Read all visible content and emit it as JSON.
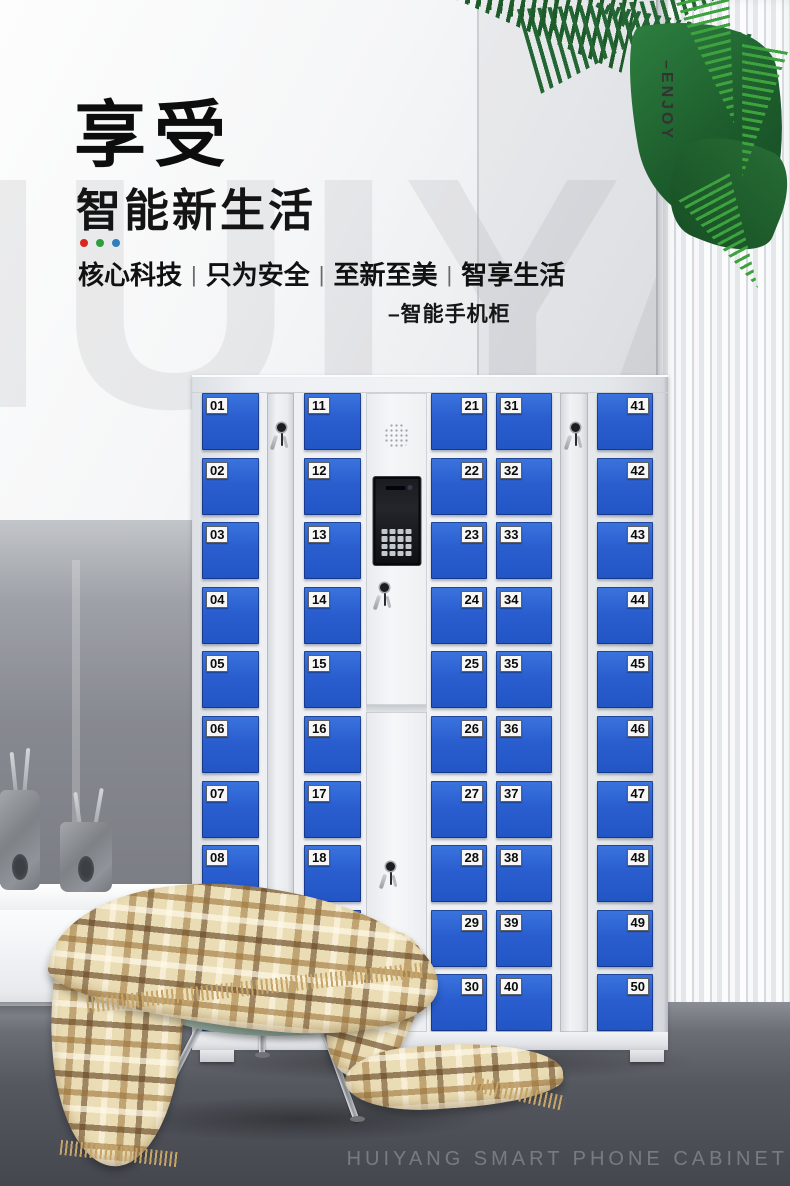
{
  "header": {
    "title": "享受",
    "subtitle": "智能新生活",
    "dot_colors": [
      "#d8271c",
      "#2e9e3e",
      "#2f7fc0"
    ],
    "tagline": [
      "核心科技",
      "只为安全",
      "至新至美",
      "智享生活"
    ],
    "separator": "|",
    "product_label": "–智能手机柜",
    "enjoy_label": "–ENJOY"
  },
  "watermark": {
    "background_text": "HUIYANG",
    "floor_text": "HUIYANG SMART PHONE CABINET"
  },
  "cabinet": {
    "door_color": "#2a5ecf",
    "body_color": "#eef0f3",
    "columns": [
      {
        "type": "doors",
        "label_side": "left",
        "numbers": [
          "01",
          "02",
          "03",
          "04",
          "05",
          "06",
          "07",
          "08",
          "09",
          "10"
        ]
      },
      {
        "type": "lock-strip"
      },
      {
        "type": "doors",
        "label_side": "left",
        "numbers": [
          "11",
          "12",
          "13",
          "14",
          "15",
          "16",
          "17",
          "18",
          "19",
          "20"
        ]
      },
      {
        "type": "control-panel"
      },
      {
        "type": "doors",
        "label_side": "right",
        "numbers": [
          "21",
          "22",
          "23",
          "24",
          "25",
          "26",
          "27",
          "28",
          "29",
          "30"
        ]
      },
      {
        "type": "doors",
        "label_side": "left",
        "numbers": [
          "31",
          "32",
          "33",
          "34",
          "35",
          "36",
          "37",
          "38",
          "39",
          "40"
        ]
      },
      {
        "type": "lock-strip"
      },
      {
        "type": "doors",
        "label_side": "right",
        "numbers": [
          "41",
          "42",
          "43",
          "44",
          "45",
          "46",
          "47",
          "48",
          "49",
          "50"
        ]
      }
    ]
  }
}
